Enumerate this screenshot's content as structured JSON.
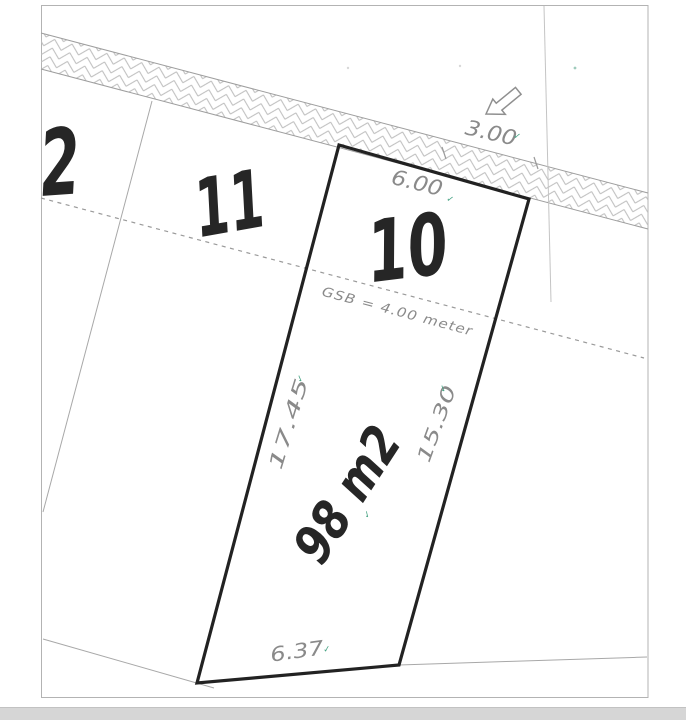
{
  "plan": {
    "title": "cadastral-site-plan",
    "road": {
      "width_label": "3.00",
      "surface": "hatched-strip"
    },
    "setback": {
      "label": "GSB  =  4.00  meter"
    },
    "parcels": {
      "lot2": {
        "number": "2"
      },
      "lot11": {
        "number": "11"
      },
      "lot10": {
        "number": "10",
        "area_label": "98 m2",
        "front_width": "6.00",
        "left_length": "17.45",
        "right_length": "15.30",
        "rear_width": "6.37"
      }
    },
    "icons": {
      "check_tick": "✓",
      "road_arrow": "block-arrow-down-left"
    },
    "colors": {
      "boundary_bold": "#222222",
      "thin_line": "#a8a8a8",
      "hatch_line": "#bdbdbd",
      "dimension_text": "#8a8a8a",
      "lot_number_text": "#262626",
      "tick_green": "#46a383",
      "frame": "#b3b3b3",
      "bottom_bar": "#d6d6d6"
    }
  }
}
